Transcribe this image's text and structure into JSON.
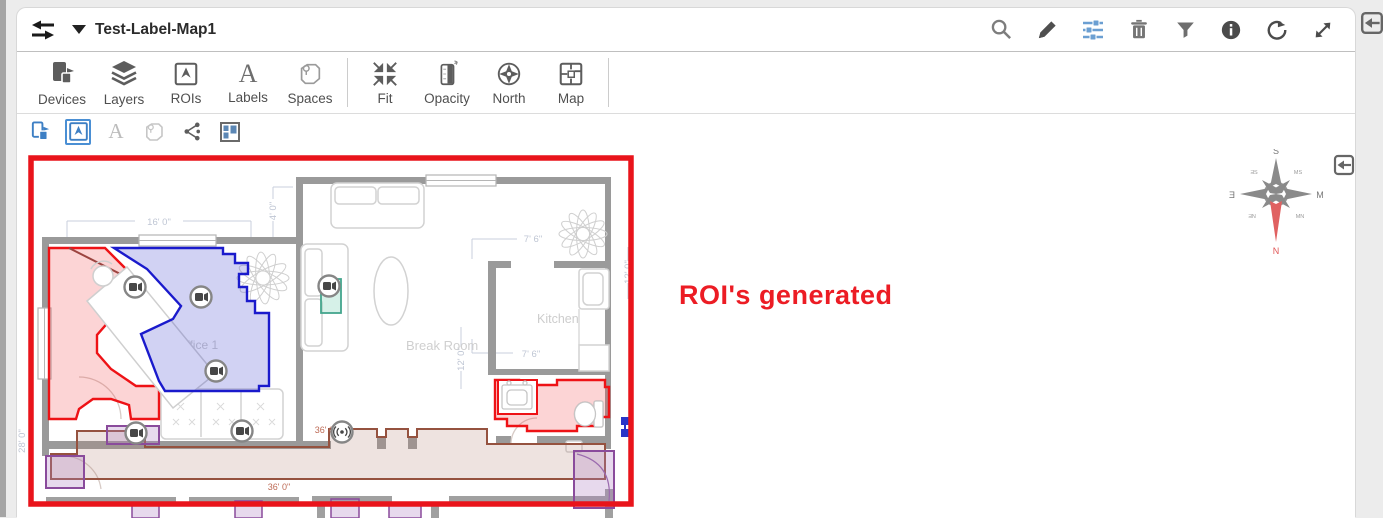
{
  "window": {
    "title": "Test-Label-Map1"
  },
  "header": {
    "map_selector_label": "Test-Label-Map1",
    "icons": [
      "swap-icon",
      "caret-down-icon",
      "search-icon",
      "edit-icon",
      "settings-sliders-icon",
      "delete-icon",
      "filter-icon",
      "info-icon",
      "reset-view-icon",
      "expand-icon",
      "collapse-panel-icon"
    ]
  },
  "toolbar": {
    "items": [
      {
        "label": "Devices",
        "icon": "devices-icon"
      },
      {
        "label": "Layers",
        "icon": "layers-icon"
      },
      {
        "label": "ROIs",
        "icon": "rois-icon"
      },
      {
        "label": "Labels",
        "icon": "labels-icon"
      },
      {
        "label": "Spaces",
        "icon": "spaces-icon"
      },
      {
        "label": "Fit",
        "icon": "fit-icon"
      },
      {
        "label": "Opacity",
        "icon": "opacity-icon"
      },
      {
        "label": "North",
        "icon": "north-icon"
      },
      {
        "label": "Map",
        "icon": "map-icon"
      }
    ]
  },
  "toolbar2": {
    "icons": [
      "draw-device-icon",
      "draw-roi-icon",
      "draw-label-icon",
      "draw-space-icon",
      "share-icon",
      "window-panes-icon"
    ],
    "active": "draw-roi-icon"
  },
  "annotation": {
    "text": "ROI's generated",
    "color": "#ec1c24"
  },
  "floor_plan": {
    "rooms": {
      "office": "Office 1",
      "break_room": "Break Room",
      "kitchen": "Kitchen"
    },
    "dimensions": {
      "office_top": "16' 0\"",
      "office_side": "4' 0\"",
      "kitchen_top": "7' 6\"",
      "kitchen_bottom": "7' 6\"",
      "hall": "12' 0\"",
      "kitchen_right": "12' 0\"",
      "corridor_top": "36' 0\"",
      "corridor_bottom": "36' 0\"",
      "left_wall": "28' 0\""
    },
    "colors": {
      "map_border": "#e9141b",
      "roi_red": "#ee1216",
      "roi_blue": "#1a1acc",
      "roi_purple": "#8a4b9c",
      "roi_brown": "#95523f",
      "roi_teal": "#44a58c",
      "accent_blue": "#5b9bd5"
    }
  },
  "compass": {
    "top": "S",
    "bottom": "N",
    "left": "Ǝ",
    "right": "M",
    "tl": "ƎS",
    "tr": "MS",
    "bl": "ƎN",
    "br": "MN"
  }
}
